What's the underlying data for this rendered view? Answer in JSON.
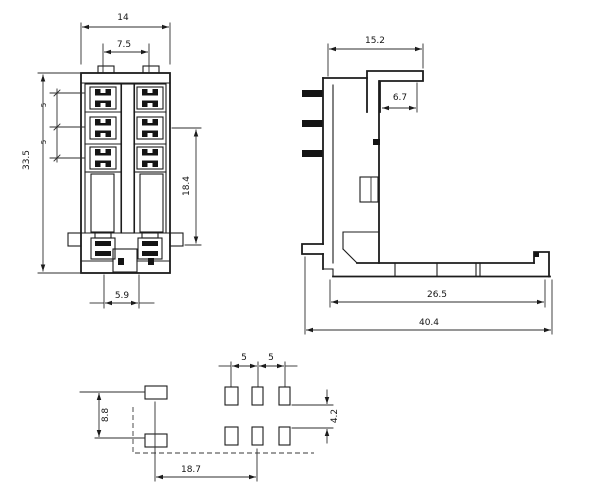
{
  "drawing": {
    "background": "#ffffff",
    "line_color": "#1c1c1c",
    "views": {
      "front": {
        "dims": {
          "overall_width": "14",
          "terminal_pitch": "7.5",
          "overall_height": "33.5",
          "row_pitch_a": "5",
          "row_pitch_b": "5",
          "terminal_span": "18.4",
          "coil_offset": "5.9"
        }
      },
      "side": {
        "dims": {
          "top_width": "15.2",
          "hook_depth": "6.7",
          "base_length": "26.5",
          "overall_length": "40.4"
        }
      },
      "bottom": {
        "dims": {
          "pin_pitch_a": "5",
          "pin_pitch_b": "5",
          "coil_pin_span": "8.8",
          "row_gap": "4.2",
          "coil_to_contact": "18.7"
        }
      }
    }
  }
}
